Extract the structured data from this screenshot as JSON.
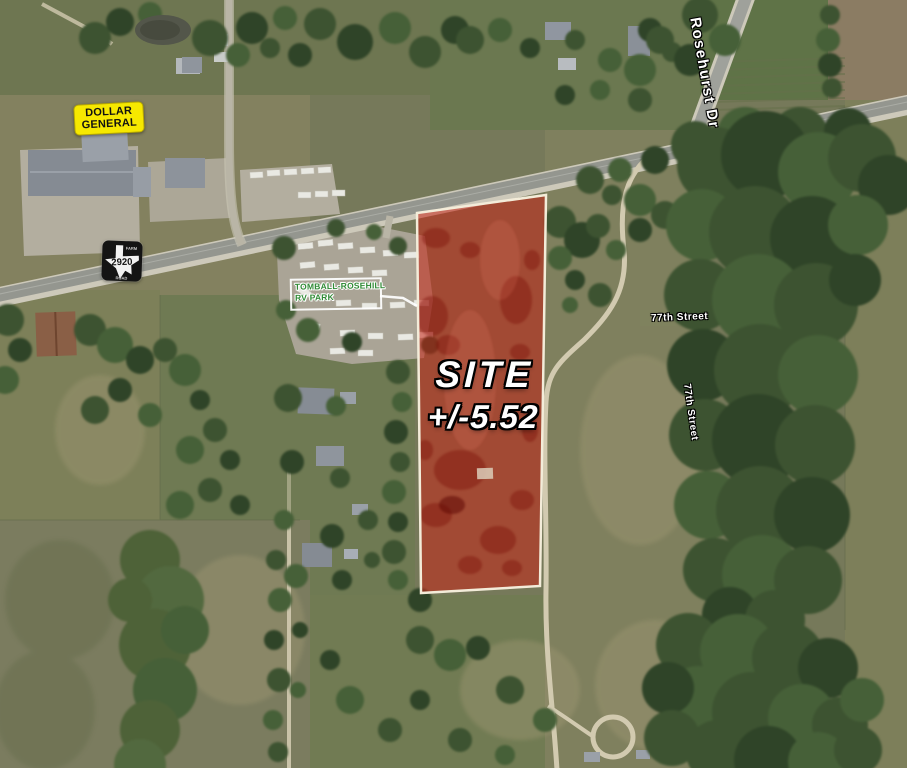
{
  "title": "Aerial site map",
  "labels": {
    "dollar_general": "DOLLAR GENERAL",
    "rv_park_line1": "TOMBALL-ROSEHILL",
    "rv_park_line2": "RV PARK",
    "highway_number": "2920",
    "highway_word_top": "FARM",
    "highway_word_bottom": "ROAD",
    "street_rosehurst": "Rosehurst Dr",
    "street_77th_upper": "77th Street",
    "street_77th_lower": "77th Street"
  },
  "site": {
    "label": "SITE",
    "area": "+/-5.52",
    "overlay_fill": "rgba(199,36,22,0.55)",
    "border_color": "#F3ECD9"
  },
  "colors": {
    "dollar_general_bg": "#F6E800",
    "rv_park_text": "#2F8A35",
    "street_label_text": "#FFFFFF",
    "highway_shield_bg": "#141414",
    "field_olive": "#76795A",
    "forest_green": "#3D5331",
    "road_asphalt": "#94968F",
    "dirt_path": "#D2CAB0"
  }
}
